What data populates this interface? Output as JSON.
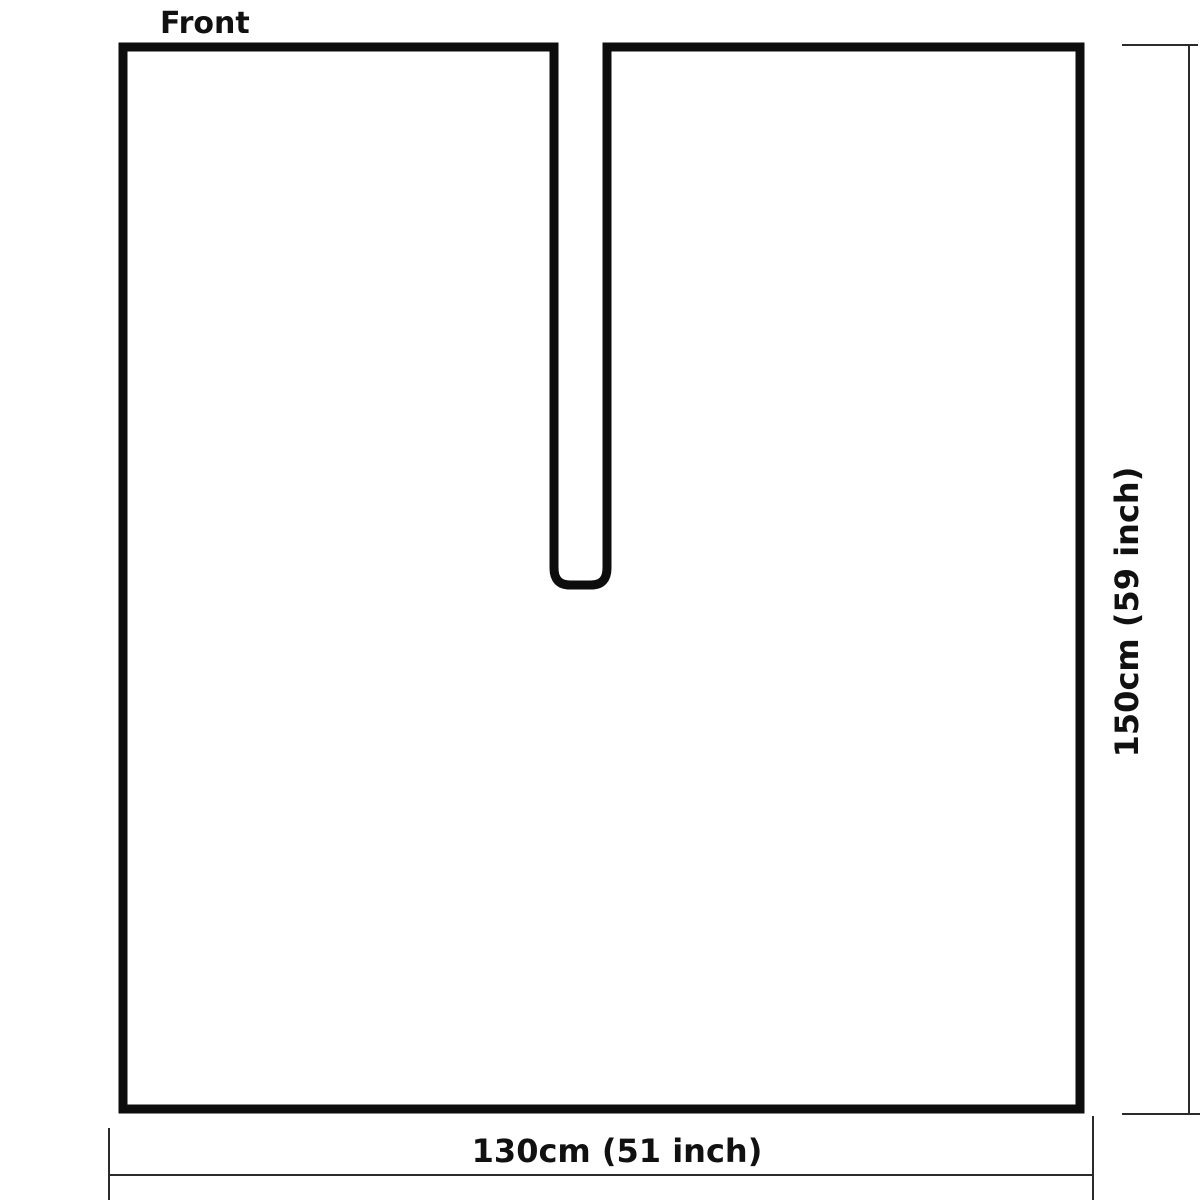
{
  "page": {
    "background": "#ffffff"
  },
  "diagram": {
    "front_label": "Front",
    "bottom_dimension_label": "130cm (51 inch)",
    "side_dimension_label": "150cm (59 inch)",
    "colors": {
      "outline": "#0d0d0d",
      "dimension_line": "#2b2b2b",
      "text": "#111111",
      "fill": "#ffffff"
    }
  }
}
